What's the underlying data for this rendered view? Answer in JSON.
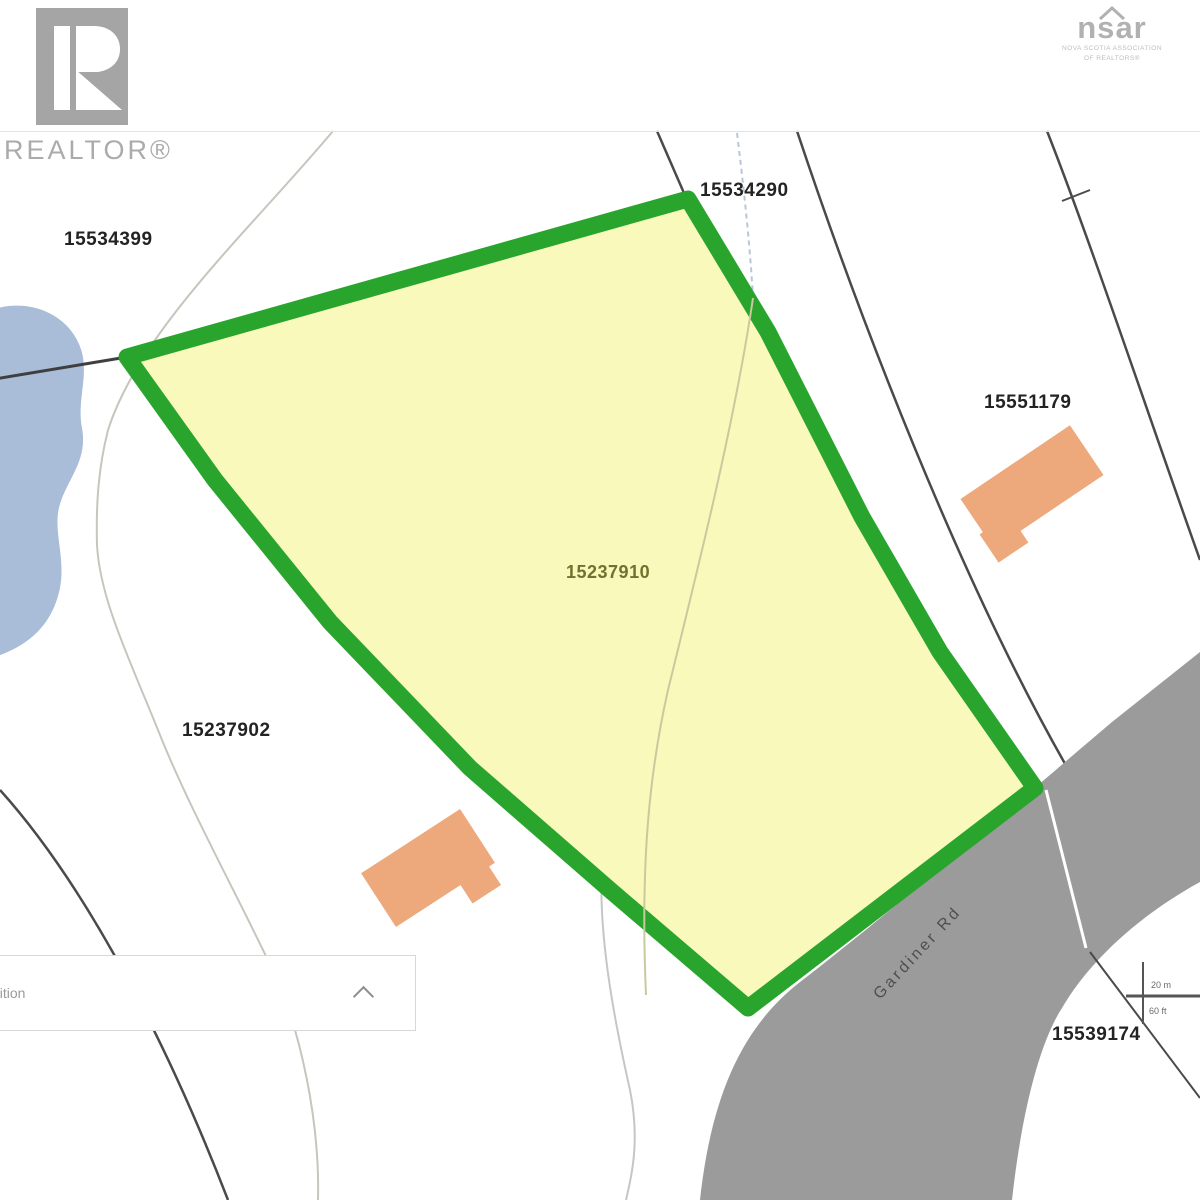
{
  "branding": {
    "realtor": {
      "word": "REALTOR®"
    },
    "nsar": {
      "left": "ns",
      "right": "ar",
      "sub_line1": "NOVA SCOTIA ASSOCIATION",
      "sub_line2": "OF REALTORS®"
    }
  },
  "map": {
    "parcel_labels": [
      {
        "pid": "15534399"
      },
      {
        "pid": "15534290"
      },
      {
        "pid": "15551179"
      },
      {
        "pid": "15237902"
      },
      {
        "pid": "15539174"
      }
    ],
    "subject_parcel": {
      "pid": "15237910"
    },
    "road_label": "Gardiner Rd",
    "scale_bar": {
      "top": "20 m",
      "bottom": "60 ft"
    },
    "edge_fragment": "6",
    "colors": {
      "subject_border": "#29a52e",
      "subject_fill": "#f9f9bb",
      "road": "#9b9b9b",
      "water": "#a9bdd8",
      "building": "#eda87c"
    }
  },
  "panel": {
    "fragment": "dition"
  }
}
